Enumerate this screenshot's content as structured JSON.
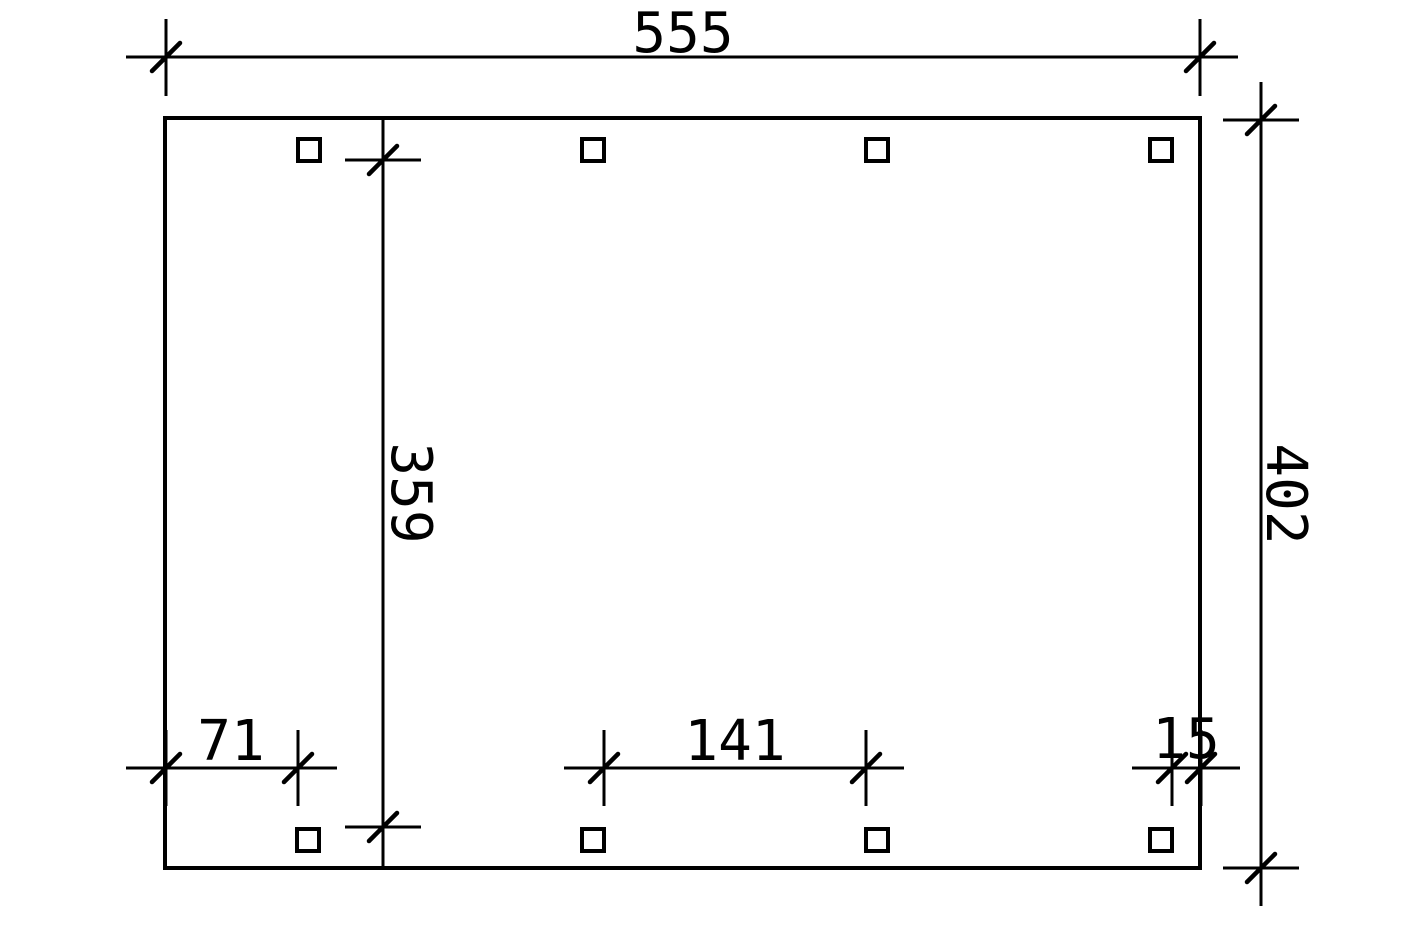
{
  "colors": {
    "line": "#000000",
    "background": "#ffffff"
  },
  "dimensions": {
    "top_width": "555",
    "right_height": "402",
    "inner_height": "359",
    "bottom_left": "71",
    "bottom_middle": "141",
    "bottom_right": "15"
  },
  "posts": {
    "marker": "square-outline",
    "count": 8
  }
}
